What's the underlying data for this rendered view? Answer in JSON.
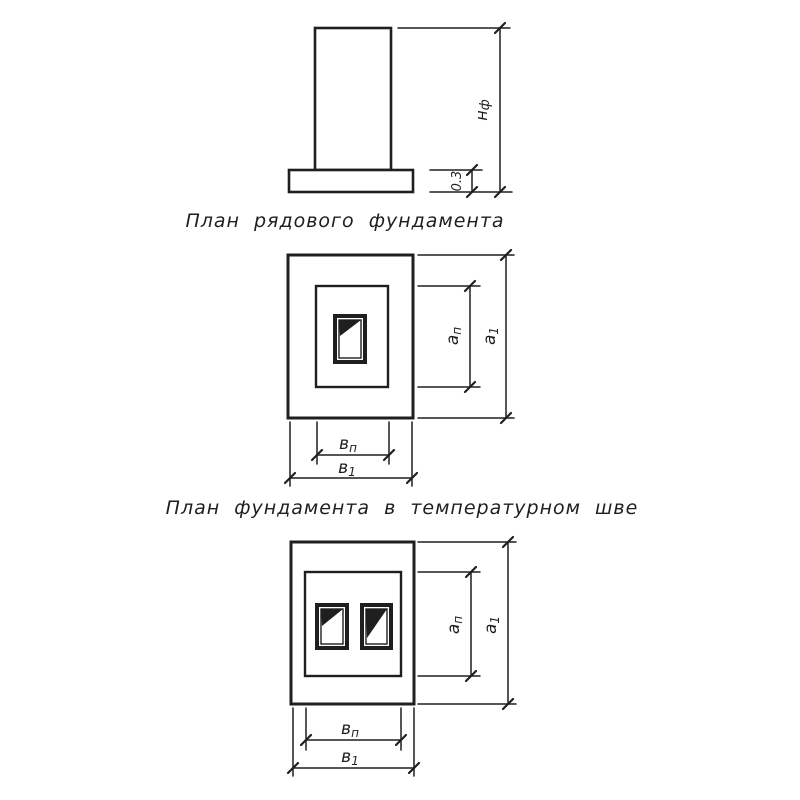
{
  "colors": {
    "ink": "#1f1f1f",
    "paper": "#ffffff"
  },
  "elevation": {
    "dim_height": {
      "base": "н",
      "sub": "ф"
    },
    "dim_slab_thickness": "0.3"
  },
  "plan_regular": {
    "title": "План рядового фундамента",
    "dim_a_pedestal": {
      "base": "а",
      "sub": "п"
    },
    "dim_a_overall": {
      "base": "а",
      "sub": "1"
    },
    "dim_b_pedestal": {
      "base": "в",
      "sub": "п"
    },
    "dim_b_overall": {
      "base": "в",
      "sub": "1"
    }
  },
  "plan_joint": {
    "title": "План фундамента в температурном шве",
    "dim_a_pedestal": {
      "base": "а",
      "sub": "п"
    },
    "dim_a_overall": {
      "base": "а",
      "sub": "1"
    },
    "dim_b_pedestal": {
      "base": "в",
      "sub": "п"
    },
    "dim_b_overall": {
      "base": "в",
      "sub": "1"
    }
  }
}
